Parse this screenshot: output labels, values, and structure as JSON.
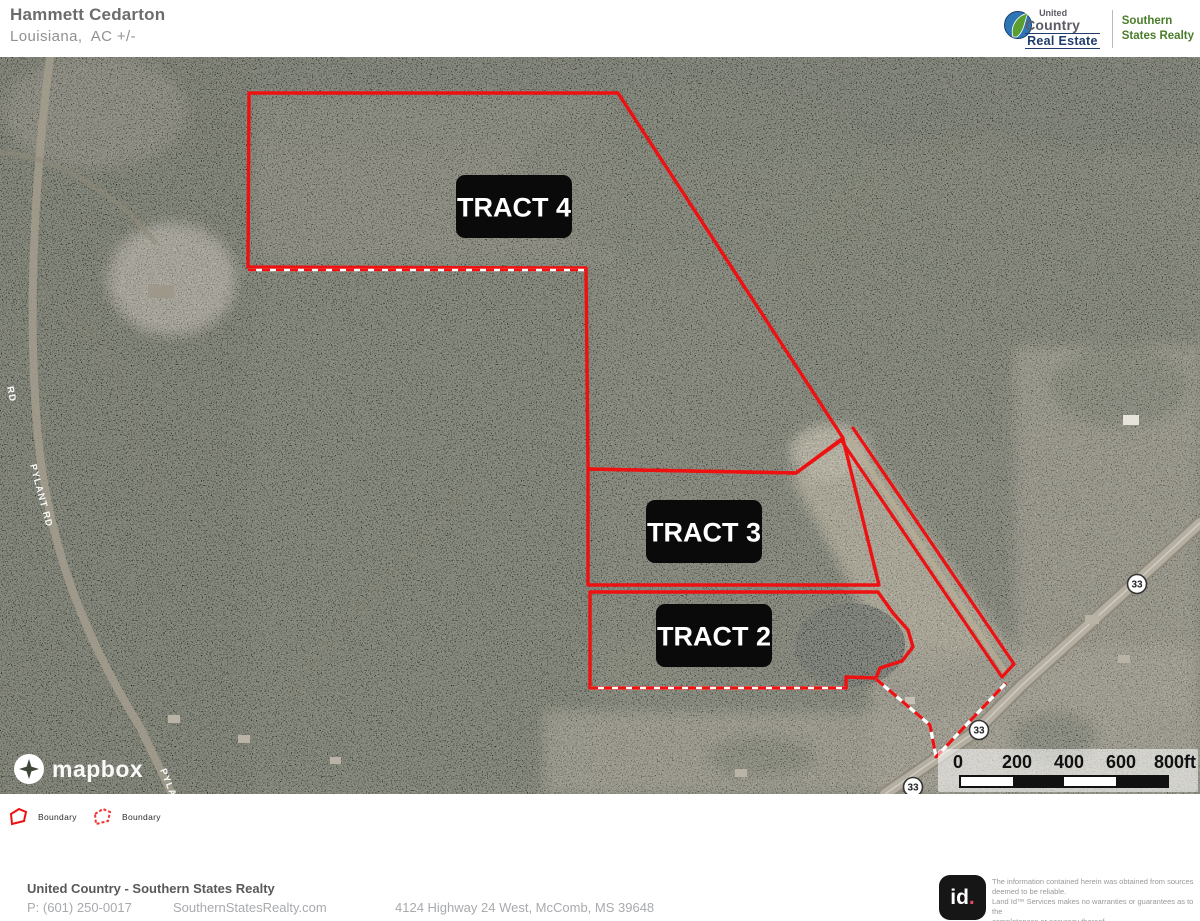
{
  "header": {
    "title": "Hammett Cedarton",
    "subtitle": "Louisiana,  AC +/-",
    "logo": {
      "united": "United",
      "country": "Country",
      "real_estate": "Real Estate",
      "office_line1": "Southern",
      "office_line2": "States Realty"
    }
  },
  "map": {
    "attribution": "mapbox",
    "tract_labels": [
      {
        "text": "TRACT 4",
        "x": 514,
        "y": 150
      },
      {
        "text": "TRACT 3",
        "x": 704,
        "y": 475
      },
      {
        "text": "TRACT 2",
        "x": 714,
        "y": 579
      }
    ],
    "road_labels": [
      {
        "text": "PYLANT RD",
        "x": 30,
        "y": 408,
        "rotate": 75
      },
      {
        "text": "PYLANT RD",
        "x": 160,
        "y": 713,
        "rotate": 68
      },
      {
        "text": "RD",
        "x": 7,
        "y": 330,
        "rotate": 78
      }
    ],
    "route_shields": [
      {
        "text": "33",
        "x": 1137,
        "y": 527
      },
      {
        "text": "33",
        "x": 979,
        "y": 673
      },
      {
        "text": "33",
        "x": 913,
        "y": 730
      }
    ],
    "scale_bar": {
      "labels": [
        "0",
        "200",
        "400",
        "600",
        "800ft"
      ],
      "label_centers": [
        20,
        79,
        131,
        183,
        237
      ],
      "segment_colors": [
        "#ffffff",
        "#111111",
        "#ffffff",
        "#111111"
      ]
    },
    "boundaries": {
      "tracts": [
        {
          "name": "tract-4",
          "points": "249,36 618,36 843,381 796,416 588,412 586,211 248,210"
        },
        {
          "name": "tract-3",
          "points": "588,412 796,416 843,382 879,528 588,528"
        },
        {
          "name": "tract-2",
          "points": "590,535 878,535 893,556 908,573 913,590 902,604 880,611 876,621 846,620 846,631 590,631"
        }
      ],
      "corridor_lines": [
        [
          [
            853,
            371
          ],
          [
            1014,
            607
          ]
        ],
        [
          [
            841,
            383
          ],
          [
            1002,
            620
          ]
        ],
        [
          [
            1002,
            620
          ],
          [
            1014,
            607
          ]
        ]
      ],
      "striped_lines": [
        [
          [
            248,
            213
          ],
          [
            586,
            213
          ]
        ],
        [
          [
            590,
            631
          ],
          [
            846,
            631
          ]
        ]
      ],
      "dashed_polyline": [
        [
          876,
          622
        ],
        [
          930,
          668
        ],
        [
          936,
          700
        ],
        [
          1006,
          626
        ]
      ]
    }
  },
  "legend": {
    "items": [
      {
        "label": "Boundary",
        "style": "solid"
      },
      {
        "label": "Boundary",
        "style": "dashed"
      }
    ]
  },
  "footer": {
    "company": "United Country - Southern States Realty",
    "phone": "P: (601) 250-0017",
    "website": "SouthernStatesRealty.com",
    "address": "4124 Highway 24 West, McComb, MS 39648"
  },
  "attribution_box": {
    "logo_text": "id",
    "logo_dot": ".",
    "lines": [
      "The information contained herein  was obtained from sources",
      "deemed to be reliable.",
      " Land Id™ Services makes no warranties or guarantees as to the",
      "completeness or accuracy thereof."
    ]
  },
  "colors": {
    "boundary_red": "#ee1111",
    "label_bg": "#0a0a0a",
    "navy": "#1f3c6e",
    "office_green": "#4a7d2b",
    "id_dot": "#e8476b"
  }
}
